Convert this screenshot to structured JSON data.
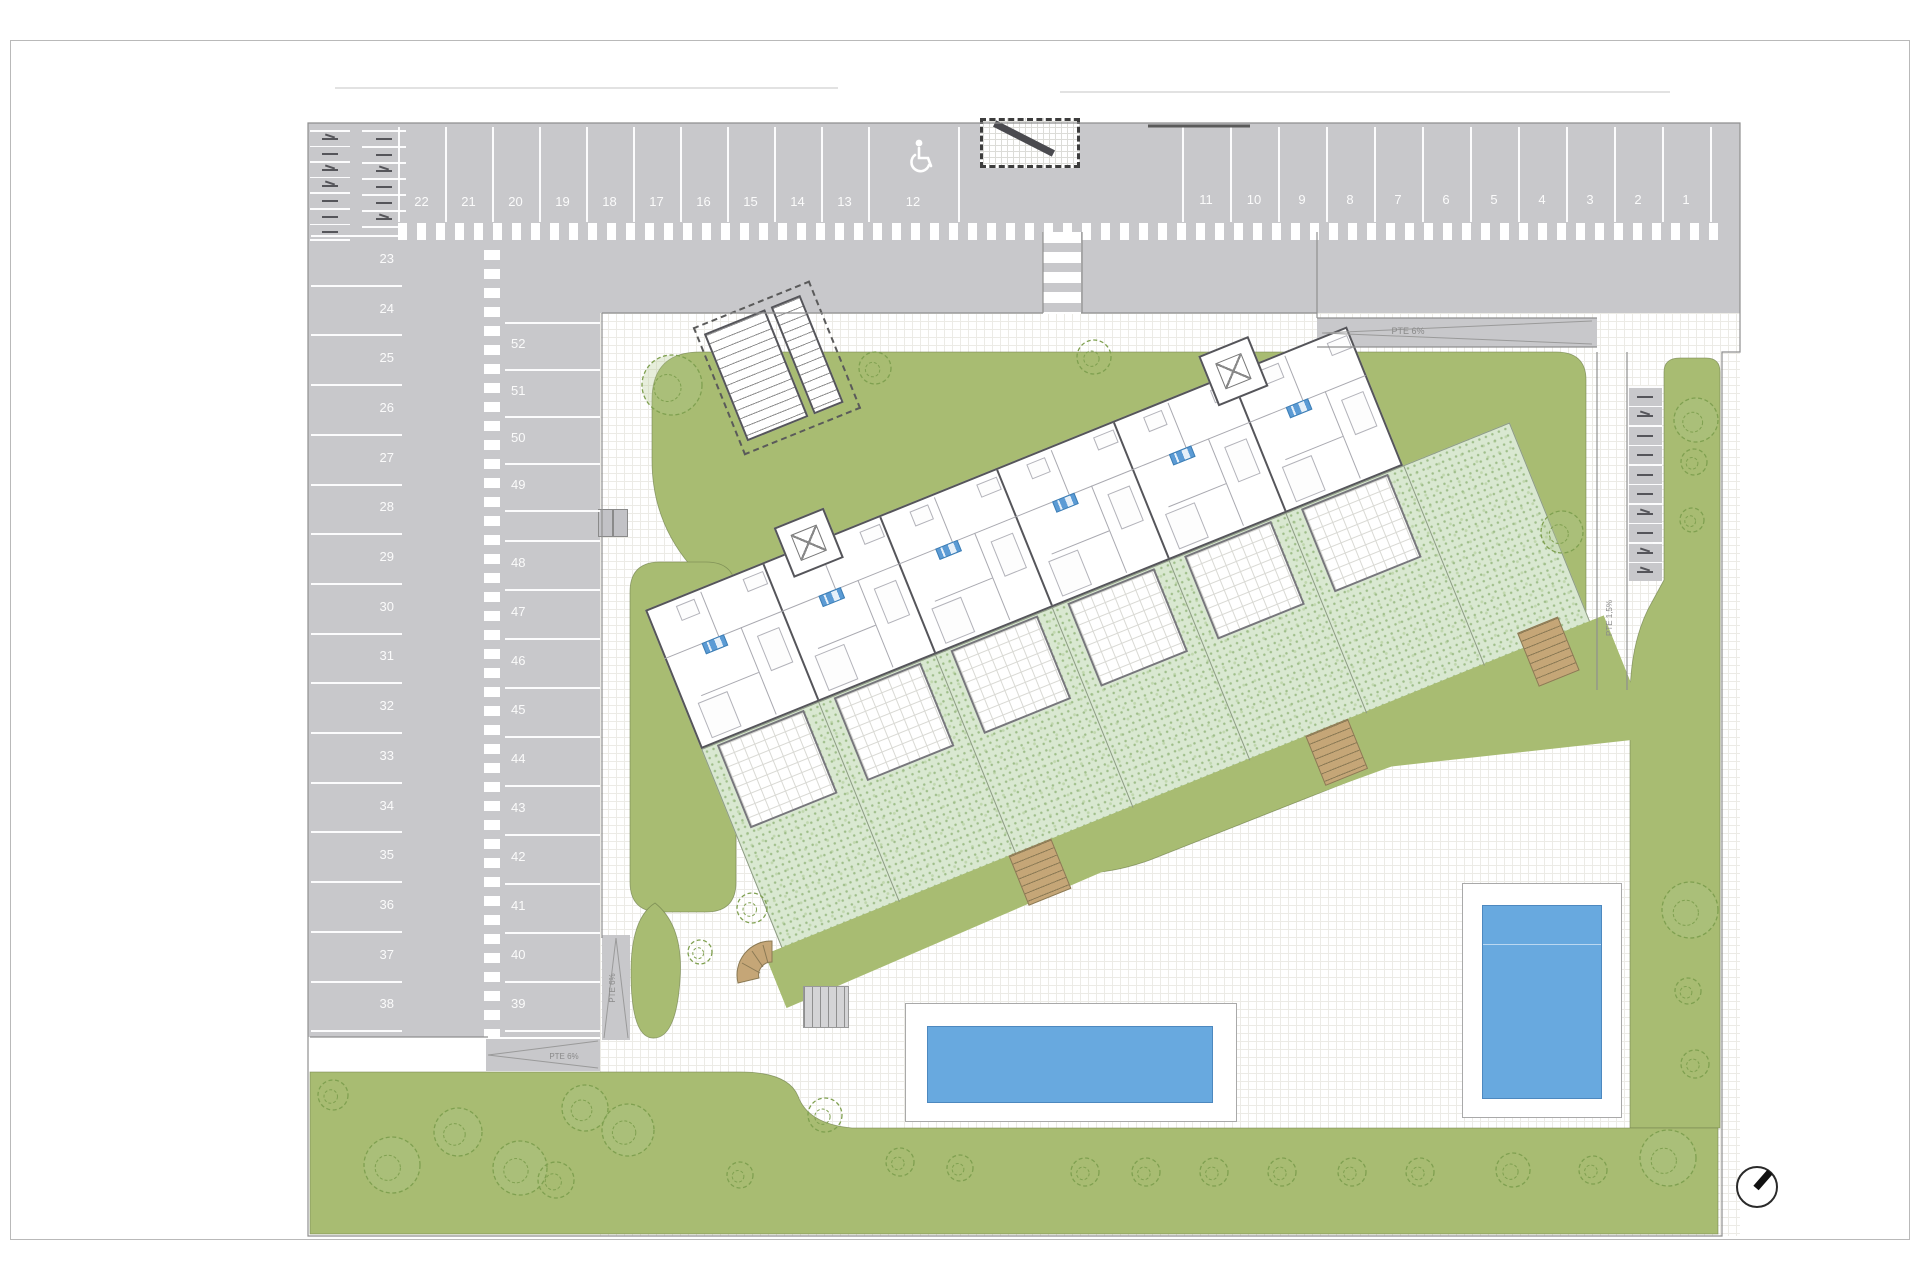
{
  "colors": {
    "road": "#c8c8cb",
    "stall_line": "#ffffff",
    "lawn": "#a8bc72",
    "private_garden": "#d9e8d1",
    "pool_water": "#68a9df",
    "wood_stair": "#c5a677",
    "unit_badge": "#5b9bd5",
    "wall": "#55555a",
    "tree_stroke": "#7fa050"
  },
  "parking": {
    "top_row_left": [
      "22",
      "21",
      "20",
      "19",
      "18",
      "17",
      "16",
      "15",
      "14",
      "13",
      "12"
    ],
    "top_row_right": [
      "11",
      "10",
      "9",
      "8",
      "7",
      "6",
      "5",
      "4",
      "3",
      "2",
      "1"
    ],
    "left_column": [
      "23",
      "24",
      "25",
      "26",
      "27",
      "28",
      "29",
      "30",
      "31",
      "32",
      "33",
      "34",
      "35",
      "36",
      "37",
      "38"
    ],
    "middle_column_upper": [
      "52",
      "51",
      "50",
      "49"
    ],
    "middle_column_lower": [
      "48",
      "47",
      "46",
      "45",
      "44",
      "43",
      "42",
      "41",
      "40",
      "39"
    ],
    "accessible_space": "12"
  },
  "ramps": {
    "top_right_label": "PTE 6%",
    "southwest_label": "PTE 6%",
    "south_vertical_label": "PTE 6%",
    "east_walkway_label": "PTE 1,5%"
  },
  "building": {
    "unit_badges": [
      "",
      "",
      "",
      "",
      "",
      ""
    ],
    "stair_towers": 2,
    "pools": 2
  }
}
